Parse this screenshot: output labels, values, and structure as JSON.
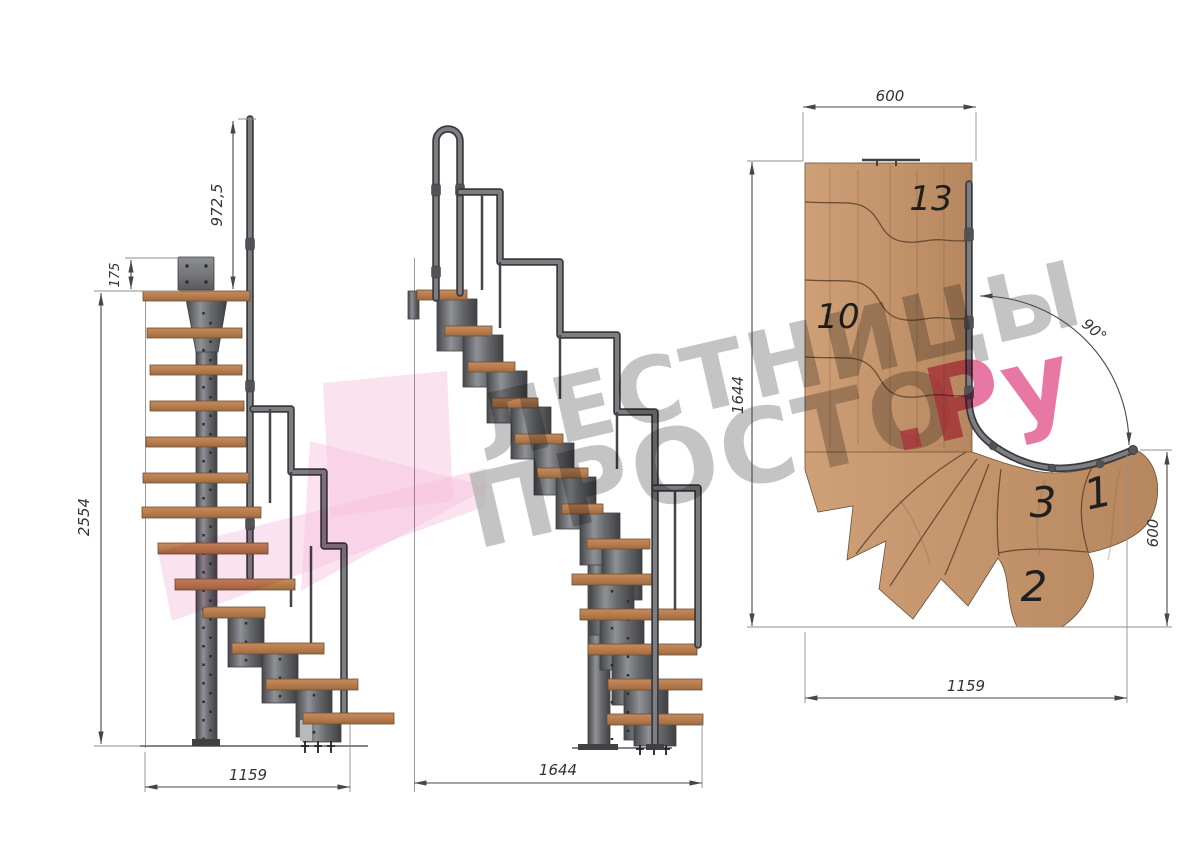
{
  "watermark": {
    "line1": "ЛЕСТНИЦЫ",
    "line2": "ПРОСТО",
    "line2_suffix": ".Ру",
    "text_color": "#a8a8a8",
    "accent_color": "#df4580",
    "arrow_color": "#f6b9da"
  },
  "front_view": {
    "dim_rail_height": "972,5",
    "dim_plate": "175",
    "dim_total_height": "2554",
    "dim_width": "1159"
  },
  "side_view": {
    "dim_length": "1644"
  },
  "plan_view": {
    "dim_landing_width": "600",
    "dim_depth": "1644",
    "dim_angle": "90°",
    "dim_exit_width": "600",
    "dim_run": "1159",
    "steps": {
      "s13": "13",
      "s10": "10",
      "s3": "3",
      "s1": "1",
      "s2": "2"
    }
  },
  "colors": {
    "wood": "#c1885a",
    "wood_plan": "#c89a6e",
    "metal": "#6a6b6f",
    "dimension": "#474747"
  }
}
